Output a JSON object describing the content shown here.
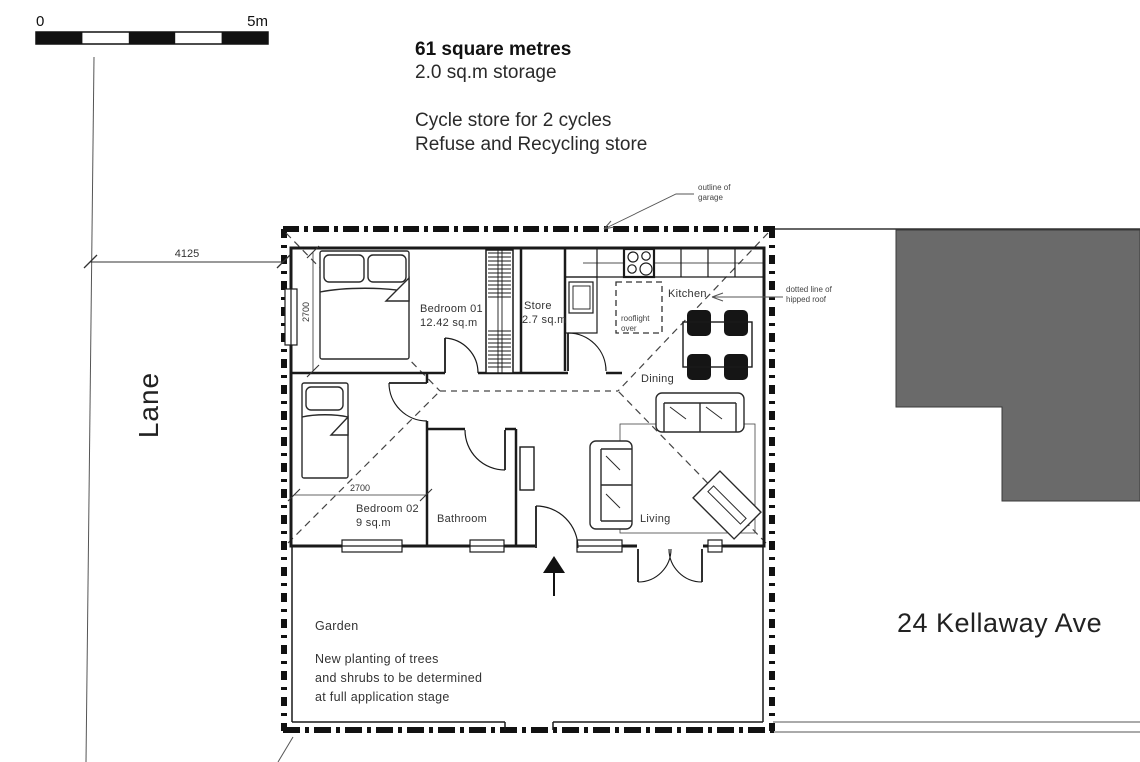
{
  "colors": {
    "ink": "#1a1a1a",
    "building_gray": "#6a6a6a",
    "paper": "#ffffff"
  },
  "scale_bar": {
    "start": "0",
    "end": "5m"
  },
  "notes": {
    "area": "61 square metres",
    "storage": "2.0 sq.m storage",
    "cycle_store": "Cycle store for 2 cycles",
    "refuse_store": "Refuse and Recycling store"
  },
  "annotations": {
    "garage_l1": "outline of",
    "garage_l2": "garage",
    "roof_l1": "dotted line of",
    "roof_l2": "hipped roof",
    "rooflight_l1": "rooflight",
    "rooflight_l2": "over"
  },
  "dimensions": {
    "lane_to_building": "4125",
    "bedroom01_width": "2700",
    "bedroom02_width": "2700"
  },
  "rooms": {
    "bedroom01_name": "Bedroom 01",
    "bedroom01_area": "12.42 sq.m",
    "store_name": "Store",
    "store_area": "2.7 sq.m",
    "kitchen": "Kitchen",
    "dining": "Dining",
    "living": "Living",
    "bedroom02_name": "Bedroom 02",
    "bedroom02_area": "9 sq.m",
    "bathroom": "Bathroom"
  },
  "site": {
    "lane": "Lane",
    "garden": "Garden",
    "garden_note_l1": "New planting of trees",
    "garden_note_l2": "and shrubs to be determined",
    "garden_note_l3": "at full application stage",
    "neighbor": "24 Kellaway Ave"
  }
}
